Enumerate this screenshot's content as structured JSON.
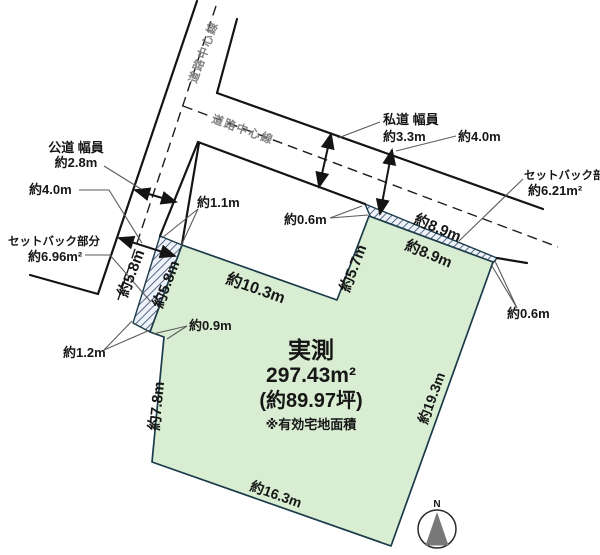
{
  "diagram": {
    "type": "land-plot-survey",
    "plot": {
      "label": "実測",
      "area_m2": "297.43m²",
      "area_tsubo": "(約89.97坪)",
      "note": "※有効宅地面積",
      "edges": {
        "notch_bottom": "約10.3m",
        "notch_right": "約5.7m",
        "west": "約7.8m",
        "south": "約16.3m",
        "east": "約19.3m",
        "jog": "約0.9m"
      }
    },
    "public_road": {
      "label": "公道 幅員",
      "width": "約2.8m",
      "future_width": "約4.0m",
      "center_line_label": "道路中心線"
    },
    "private_road": {
      "label": "私道 幅員",
      "width": "約3.3m",
      "future_width": "約4.0m",
      "center_line_label": "道路中心線"
    },
    "setback_west": {
      "label": "セットバック部分",
      "area": "約6.96m²",
      "top_width": "約1.1m",
      "bottom_width": "約1.2m",
      "length_road_side": "約5.8m",
      "length_plot_side": "約5.8m"
    },
    "setback_north": {
      "label": "セットバック部分",
      "area": "約6.21m²",
      "west_width": "約0.6m",
      "east_width": "約0.6m",
      "length_road_side": "約8.9m",
      "length_plot_side": "約8.9m"
    },
    "compass": {
      "north": "N"
    },
    "colors": {
      "plot_fill": "#d9edd2",
      "plot_border": "#1b3b4a",
      "hatch_fill": "#eef3fa",
      "hatch_line": "#3c4e6e",
      "road_line": "#141414",
      "leader_line": "#5a5a5a",
      "road_label_gray": "#828282",
      "compass_triangle": "#787878",
      "text": "#161616"
    }
  }
}
